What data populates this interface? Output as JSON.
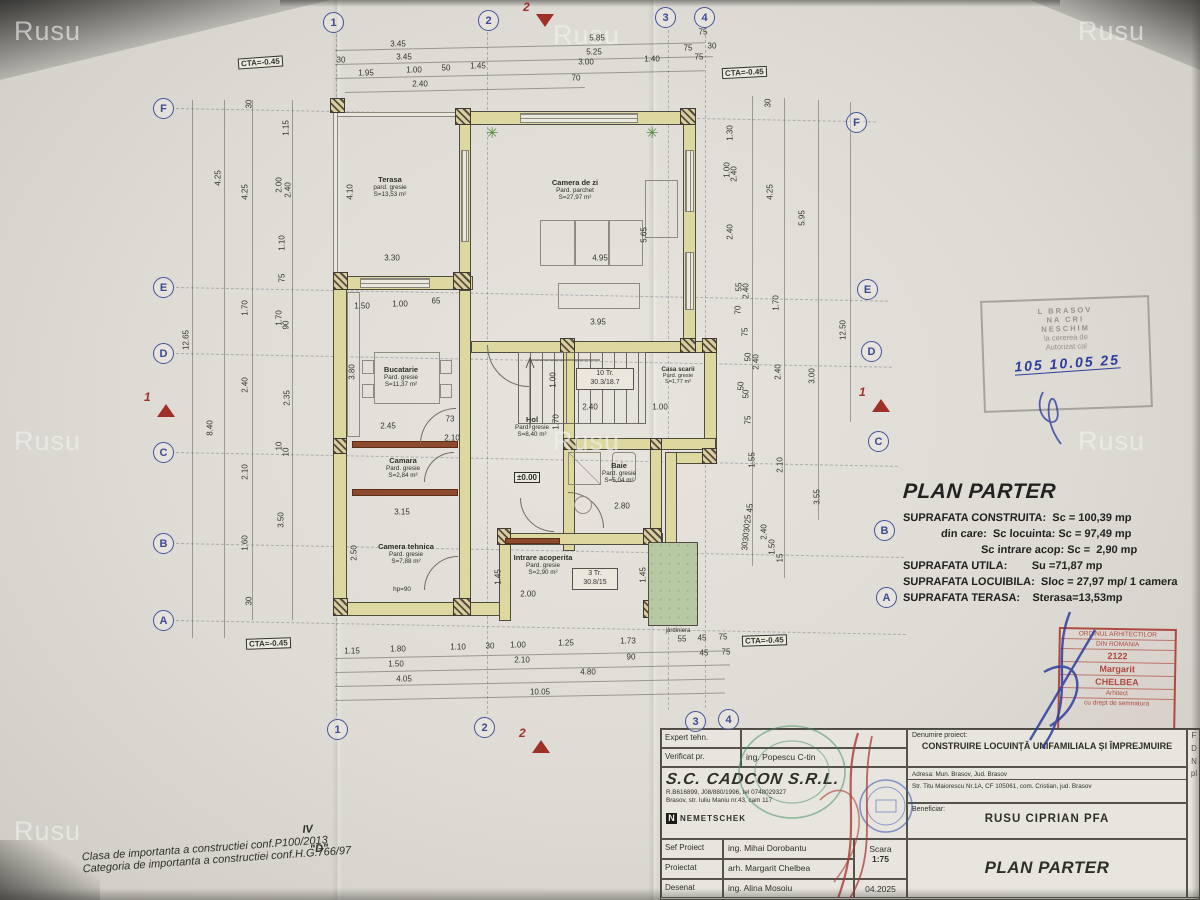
{
  "watermark": "Rusu",
  "watermark_positions": [
    [
      14,
      16
    ],
    [
      553,
      20
    ],
    [
      1078,
      16
    ],
    [
      14,
      426
    ],
    [
      553,
      426
    ],
    [
      1078,
      426
    ],
    [
      14,
      816
    ]
  ],
  "cta_text": "CTA=-0.45",
  "cta_positions": [
    [
      238,
      57,
      -4
    ],
    [
      722,
      67,
      -3
    ],
    [
      246,
      638,
      -2
    ],
    [
      742,
      635,
      -2
    ]
  ],
  "grid_bubbles": [
    [
      "1",
      333,
      22
    ],
    [
      "2",
      488,
      20
    ],
    [
      "3",
      665,
      17
    ],
    [
      "4",
      704,
      17
    ],
    [
      "1",
      337,
      729
    ],
    [
      "2",
      484,
      727
    ],
    [
      "3",
      695,
      721
    ],
    [
      "4",
      728,
      719
    ],
    [
      "F",
      163,
      108
    ],
    [
      "E",
      163,
      287
    ],
    [
      "D",
      163,
      353
    ],
    [
      "C",
      163,
      452
    ],
    [
      "B",
      163,
      543
    ],
    [
      "A",
      163,
      620
    ],
    [
      "F",
      856,
      122
    ],
    [
      "E",
      867,
      289
    ],
    [
      "D",
      871,
      351
    ],
    [
      "C",
      878,
      441
    ],
    [
      "B",
      884,
      530
    ],
    [
      "A",
      886,
      597
    ]
  ],
  "section_markers": [
    {
      "t": "2",
      "x": 545,
      "y": 14,
      "d": "down"
    },
    {
      "t": "2",
      "x": 541,
      "y": 740,
      "d": "up"
    },
    {
      "t": "1",
      "x": 166,
      "y": 404,
      "d": "up"
    },
    {
      "t": "1",
      "x": 881,
      "y": 399,
      "d": "up"
    }
  ],
  "dims": [
    [
      "3.45",
      398,
      44
    ],
    [
      "5.85",
      597,
      38
    ],
    [
      "75",
      703,
      32
    ],
    [
      "30",
      341,
      60
    ],
    [
      "3.45",
      404,
      57
    ],
    [
      "5.25",
      594,
      52
    ],
    [
      "75",
      688,
      48
    ],
    [
      "30",
      712,
      46
    ],
    [
      "1.95",
      366,
      73
    ],
    [
      "1.00",
      414,
      70
    ],
    [
      "50",
      446,
      68
    ],
    [
      "1.45",
      478,
      66
    ],
    [
      "3.00",
      586,
      62
    ],
    [
      "1.40",
      652,
      59
    ],
    [
      "75",
      699,
      57
    ],
    [
      "2.40",
      420,
      84
    ],
    [
      "70",
      576,
      78
    ],
    [
      "1.15",
      352,
      651
    ],
    [
      "1.80",
      398,
      649
    ],
    [
      "1.10",
      458,
      647
    ],
    [
      "30",
      490,
      646
    ],
    [
      "1.00",
      518,
      645
    ],
    [
      "1.25",
      566,
      643
    ],
    [
      "1.73",
      628,
      641
    ],
    [
      "55",
      682,
      639
    ],
    [
      "45",
      702,
      638
    ],
    [
      "75",
      723,
      637
    ],
    [
      "1.50",
      396,
      664
    ],
    [
      "2.10",
      522,
      660
    ],
    [
      "90",
      631,
      657
    ],
    [
      "45",
      704,
      653
    ],
    [
      "75",
      726,
      652
    ],
    [
      "4.05",
      404,
      679
    ],
    [
      "4.80",
      588,
      672
    ],
    [
      "10.05",
      540,
      692
    ],
    [
      "30",
      249,
      104,
      1
    ],
    [
      "4.25",
      218,
      178,
      1
    ],
    [
      "4.25",
      245,
      192,
      1
    ],
    [
      "1.15",
      286,
      128,
      1
    ],
    [
      "2.00",
      279,
      185,
      1
    ],
    [
      "2.40",
      288,
      190,
      1
    ],
    [
      "1.10",
      282,
      243,
      1
    ],
    [
      "75",
      282,
      278,
      1
    ],
    [
      "1.70",
      245,
      308,
      1
    ],
    [
      "1.70",
      279,
      318,
      1
    ],
    [
      "90",
      286,
      325,
      1
    ],
    [
      "12.65",
      186,
      340,
      1
    ],
    [
      "2.40",
      245,
      385,
      1
    ],
    [
      "2.35",
      287,
      398,
      1
    ],
    [
      "8.40",
      210,
      428,
      1
    ],
    [
      "10",
      279,
      446,
      1
    ],
    [
      "10",
      286,
      452,
      1
    ],
    [
      "2.10",
      245,
      472,
      1
    ],
    [
      "3.50",
      281,
      520,
      1
    ],
    [
      "1.60",
      245,
      543,
      1
    ],
    [
      "30",
      249,
      601,
      1
    ],
    [
      "30",
      768,
      103,
      1
    ],
    [
      "1.30",
      730,
      133,
      1
    ],
    [
      "1.00",
      727,
      170,
      1
    ],
    [
      "2.40",
      734,
      174,
      1
    ],
    [
      "4.25",
      770,
      192,
      1
    ],
    [
      "2.40",
      730,
      232,
      1
    ],
    [
      "5.95",
      802,
      218,
      1
    ],
    [
      "55",
      739,
      287,
      1
    ],
    [
      "2.40",
      746,
      291,
      1
    ],
    [
      "70",
      738,
      310,
      1
    ],
    [
      "1.70",
      776,
      303,
      1
    ],
    [
      "75",
      745,
      332,
      1
    ],
    [
      "12.50",
      843,
      330,
      1
    ],
    [
      "50",
      748,
      357,
      1
    ],
    [
      "2.40",
      756,
      362,
      1
    ],
    [
      "2.40",
      778,
      372,
      1
    ],
    [
      "3.00",
      812,
      376,
      1
    ],
    [
      "50",
      741,
      386,
      1
    ],
    [
      "50",
      746,
      394,
      1
    ],
    [
      "75",
      748,
      420,
      1
    ],
    [
      "1.55",
      752,
      460,
      1
    ],
    [
      "2.10",
      780,
      465,
      1
    ],
    [
      "3.55",
      817,
      497,
      1
    ],
    [
      "45",
      750,
      508,
      1
    ],
    [
      "25",
      748,
      519,
      1
    ],
    [
      "30",
      747,
      528,
      1
    ],
    [
      "30",
      746,
      537,
      1
    ],
    [
      "30",
      745,
      546,
      1
    ],
    [
      "2.40",
      764,
      532,
      1
    ],
    [
      "1.50",
      772,
      547,
      1
    ],
    [
      "15",
      780,
      558,
      1
    ],
    [
      "4.10",
      350,
      192,
      1
    ],
    [
      "3.30",
      392,
      258
    ],
    [
      "1.50",
      362,
      306
    ],
    [
      "1.00",
      400,
      304
    ],
    [
      "65",
      436,
      301
    ],
    [
      "4.95",
      600,
      258
    ],
    [
      "5.65",
      644,
      235,
      1
    ],
    [
      "3.95",
      598,
      322
    ],
    [
      "2.45",
      388,
      426
    ],
    [
      "73",
      450,
      419
    ],
    [
      "2.10",
      452,
      438
    ],
    [
      "3.80",
      352,
      372,
      1
    ],
    [
      "3.15",
      402,
      512
    ],
    [
      "2.50",
      354,
      553,
      1
    ],
    [
      "2.40",
      590,
      407
    ],
    [
      "1.00",
      660,
      407
    ],
    [
      "1.00",
      553,
      380,
      1
    ],
    [
      "1.70",
      556,
      422,
      1
    ],
    [
      "2.80",
      622,
      506
    ],
    [
      "2.00",
      528,
      594
    ],
    [
      "1.45",
      498,
      577,
      1
    ],
    [
      "1.45",
      643,
      575,
      1
    ]
  ],
  "rooms": [
    {
      "name": "Terasa",
      "floor": "pard. gresie",
      "area": "S=13,53 m²"
    },
    {
      "name": "Camera de zi",
      "floor": "Pard. parchet",
      "area": "S=27,97 m²"
    },
    {
      "name": "Bucatarie",
      "floor": "Pard. gresie",
      "area": "S=11,37 m²"
    },
    {
      "name": "Camara",
      "floor": "Pard. gresie",
      "area": "S=2,84 m²"
    },
    {
      "name": "Camera tehnica",
      "floor": "Pard. gresie",
      "area": "S=7,88 m²",
      "extra": "hp=90"
    },
    {
      "name": "Hol",
      "floor": "Pard. gresie",
      "area": "S=8,40 m²"
    },
    {
      "name": "Casa scarii",
      "floor": "Pard. gresie",
      "area": "S=1,77 m²"
    },
    {
      "name": "Baie",
      "floor": "Pard. gresie",
      "area": "S=5,04 m²"
    },
    {
      "name": "Intrare acoperita",
      "floor": "Pard. gresie",
      "area": "S=2,90 m²"
    },
    {
      "name": "jardiniera"
    }
  ],
  "stair_notes": {
    "s1a": "10 Tr.",
    "s1b": "30.3/18.7",
    "s2a": "3 Tr.",
    "s2b": "30.8/15"
  },
  "level_marker": "±0.00",
  "areas": {
    "title": "PLAN PARTER",
    "lines": [
      {
        "t": "SUPRAFATA CONSTRUITA:  Sc = 100,39 mp",
        "i": 0
      },
      {
        "t": "din care:  Sc locuinta: Sc = 97,49 mp",
        "i": 1
      },
      {
        "t": "Sc intrare acop: Sc =  2,90 mp",
        "i": 2
      },
      {
        "t": "SUPRAFATA UTILA:        Su =71,87 mp",
        "i": 0
      },
      {
        "t": "SUPRAFATA LOCUIBILA:  Sloc = 27,97 mp/ 1 camera",
        "i": 0
      },
      {
        "t": "SUPRAFATA TERASA:    Sterasa=13,53mp",
        "i": 0
      }
    ]
  },
  "stamp_top": {
    "lines": [
      "L BRASOV",
      "NA CRI",
      "NESCHIM",
      "la cererea de",
      "Autorizat cal"
    ],
    "hand": "105  10.05  25"
  },
  "stamp_red": {
    "lines": [
      "ORDINUL ARHITECTILOR",
      "DIN ROMANIA",
      "2122",
      "Margarit",
      "CHELBEA",
      "Arhitect",
      "cu drept de semnatura"
    ]
  },
  "titleblock": {
    "rows_left": [
      [
        "Expert tehn.",
        ""
      ],
      [
        "Verificat pr.",
        "ing. Popescu C-tin"
      ]
    ],
    "company": {
      "name": "S.C. CADCON S.R.L.",
      "reg": "R.B616899, J08/880/1996, tel 0748029327",
      "addr": "Brasov, str. Iuliu Maniu nr.43, cam 117",
      "logo_n": "N",
      "logo": "NEMETSCHEK"
    },
    "rows_bottom": [
      [
        "Sef Proiect",
        "ing. Mihai Dorobantu"
      ],
      [
        "Proiectat",
        "arh. Margarit Chelbea"
      ],
      [
        "Desenat",
        "ing. Alina Mosoiu"
      ]
    ],
    "scara_label": "Scara",
    "scara": "1:75",
    "date": "04.2025",
    "denumire_label": "Denumire proiect:",
    "denumire": "CONSTRUIRE LOCUINȚĂ UNIFAMILIALA ȘI ÎMPREJMUIRE",
    "adresa1": "Adresa: Mun. Brasov, Jud. Brasov",
    "adresa2": "Str. Titu Maiorescu Nr.1A, CF 105061, com. Cristian, jud. Brasov",
    "beneficiar_label": "Beneficiar:",
    "beneficiar": "RUSU CIPRIAN PFA",
    "plansa": "PLAN PARTER",
    "edge_letters": [
      "F",
      "D",
      "N",
      "pl"
    ]
  },
  "footnotes": {
    "l1": "Clasa de importanta a constructiei conf.P100/2013",
    "v1": "IV",
    "l2": "Categoria de importanta a constructiei conf.H.G.766/97",
    "v2": "\"D\""
  }
}
